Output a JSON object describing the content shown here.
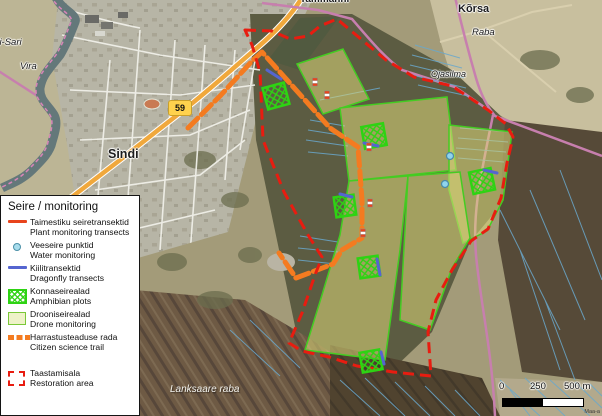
{
  "labels": {
    "tammanni": "Tammänni",
    "korsa": "Kõrsa",
    "raba": "Raba",
    "ojasilma": "Ojasilma",
    "vira": "Vira",
    "sari": "rdi-Sari",
    "sindi": "Sindi",
    "lanksaare": "Lanksaare raba",
    "road_shield": "59"
  },
  "scale_bar": {
    "t0": "0",
    "t1": "250",
    "t2": "500 m"
  },
  "attribution": "Maa-a",
  "legend": {
    "title": "Seire / monitoring",
    "items": [
      {
        "id": "plant",
        "line1": "Taimestiku seiretransektid",
        "line2": "Plant monitoring transects"
      },
      {
        "id": "water",
        "line1": "Veeseire punktid",
        "line2": "Water monitoring"
      },
      {
        "id": "dragonfly",
        "line1": "Kiilitransektid",
        "line2": "Dragonfly transects"
      },
      {
        "id": "amphibian",
        "line1": "Konnaseirealad",
        "line2": "Amphibian plots"
      },
      {
        "id": "drone",
        "line1": "Drooniseirealad",
        "line2": "Drone monitoring"
      },
      {
        "id": "citizen",
        "line1": "Harrastusteaduse rada",
        "line2": "Citizen science trail"
      },
      {
        "id": "restoration",
        "line1": "Taastamisala",
        "line2": "Restoration area"
      }
    ]
  },
  "colors": {
    "plant_transect": "#e8441c",
    "water_point": "#a8dcec",
    "dragonfly_transect": "#5565d0",
    "amphibian_plot": "#2ed313",
    "drone_area_fill": "#eef2c8",
    "drone_area_border": "#7ac838",
    "citizen_trail": "#f47b20",
    "restoration_boundary": "#e81c10",
    "highway": "#f0a83c",
    "minor_road": "#c77fae"
  }
}
